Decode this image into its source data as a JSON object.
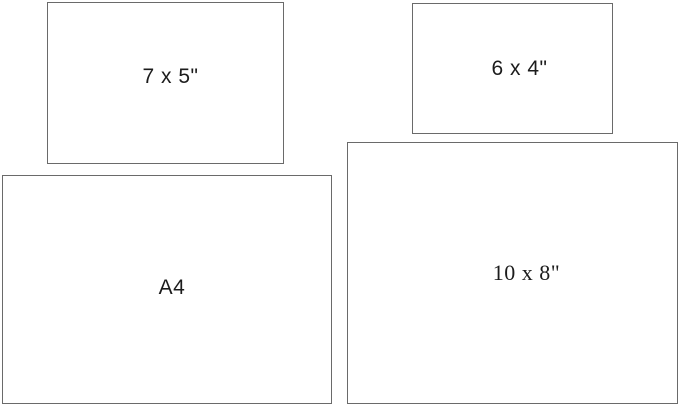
{
  "canvas": {
    "background_color": "#ffffff",
    "border_color": "#6a6a6a",
    "text_color": "#1c1c1c"
  },
  "rectangles": [
    {
      "id": "7x5",
      "label": "7 x 5\"",
      "position": "top-left"
    },
    {
      "id": "6x4",
      "label": "6 x 4\"",
      "position": "top-right"
    },
    {
      "id": "a4",
      "label": "A4",
      "position": "bottom-left"
    },
    {
      "id": "10x8",
      "label": "10 x 8\"",
      "position": "bottom-right"
    }
  ]
}
